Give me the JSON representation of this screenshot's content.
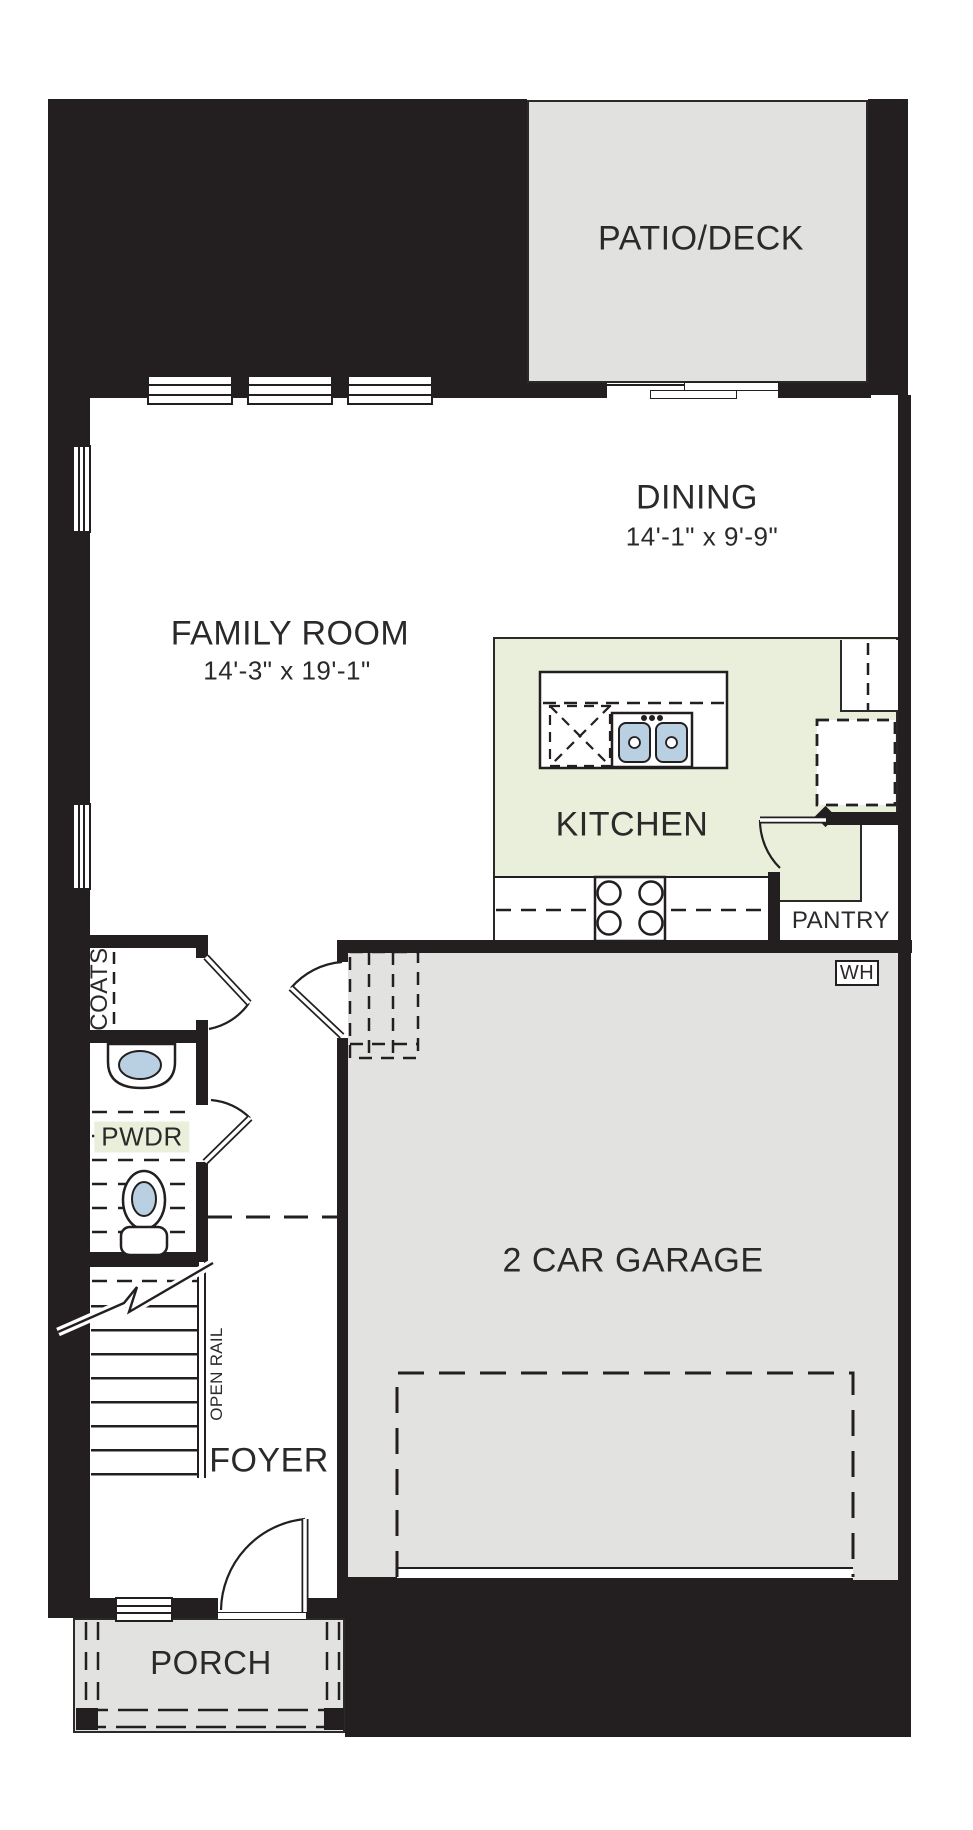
{
  "rooms": {
    "patio_deck": {
      "label": "PATIO/DECK"
    },
    "dining": {
      "label": "DINING",
      "dims": "14'-1\" x 9'-9\""
    },
    "family_room": {
      "label": "FAMILY ROOM",
      "dims": "14'-3\" x 19'-1\""
    },
    "kitchen": {
      "label": "KITCHEN"
    },
    "pantry": {
      "label": "PANTRY"
    },
    "powder": {
      "label": "PWDR"
    },
    "coats": {
      "label": "COATS"
    },
    "foyer": {
      "label": "FOYER"
    },
    "garage": {
      "label": "2 CAR GARAGE"
    },
    "porch": {
      "label": "PORCH"
    }
  },
  "annotations": {
    "water_heater": "WH",
    "open_rail": "OPEN RAIL"
  },
  "colors": {
    "wall": "#231f20",
    "line": "#2b2a29",
    "kitchen_green": "#e9efdb",
    "area_gray": "#e2e3e1",
    "patio_gray": "#e1e2e0",
    "fixture_blue": "#b9d0e2"
  }
}
